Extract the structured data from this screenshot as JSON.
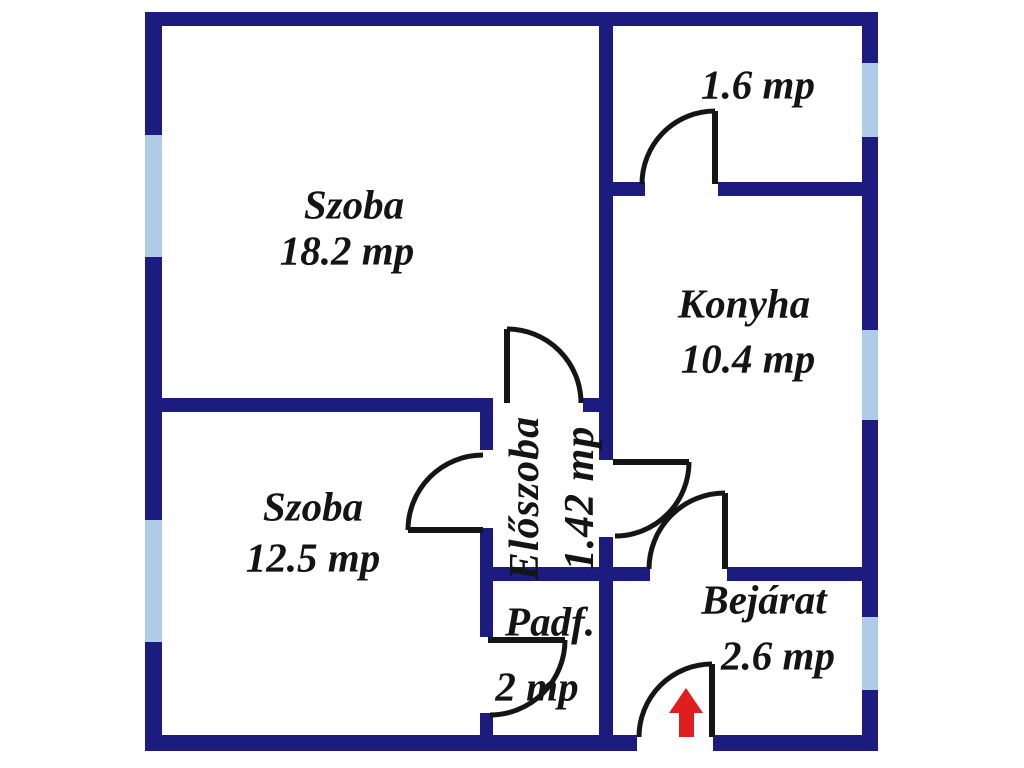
{
  "floorplan": {
    "title": "apartment-floor-plan",
    "wall_color": "#1b1b80",
    "window_color": "#aecbe8",
    "door_color": "#151515",
    "arrow_color": "#e01e1e",
    "area_unit": "mp",
    "rooms": [
      {
        "id": "szoba-large",
        "name": "Szoba",
        "area": "18.2 mp"
      },
      {
        "id": "kamra",
        "name": "",
        "area": "1.6 mp"
      },
      {
        "id": "konyha",
        "name": "Konyha",
        "area": "10.4 mp"
      },
      {
        "id": "szoba-small",
        "name": "Szoba",
        "area": "12.5 mp"
      },
      {
        "id": "eloszoba",
        "name": "Előszoba",
        "area": "1.42 mp"
      },
      {
        "id": "padlasfeljaro",
        "name": "Padf.",
        "area": "2 mp"
      },
      {
        "id": "bejarat",
        "name": "Bejárat",
        "area": "2.6 mp"
      }
    ]
  }
}
